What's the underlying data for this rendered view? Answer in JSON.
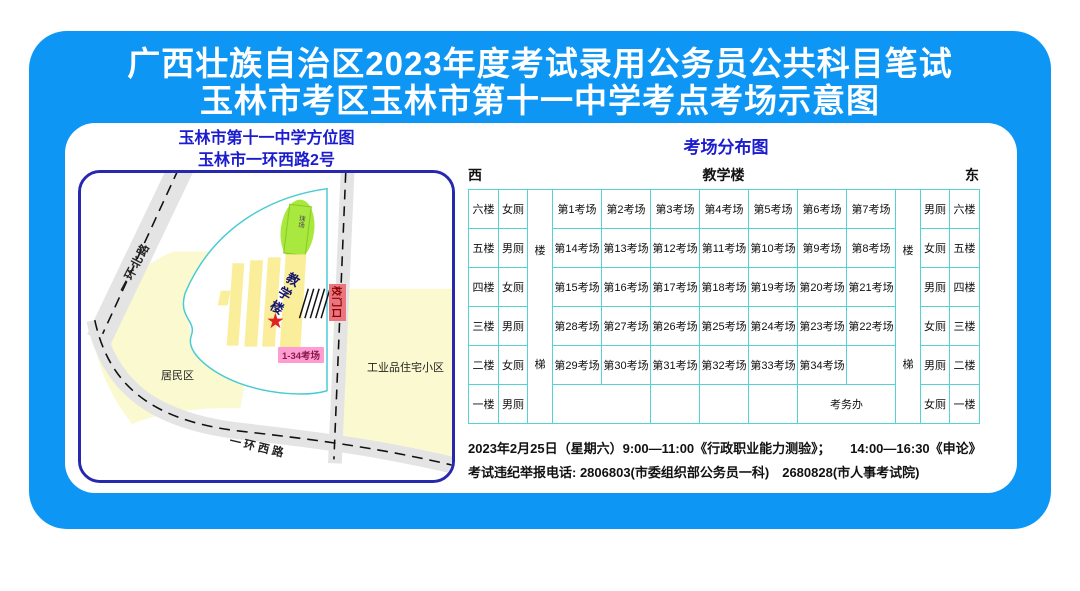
{
  "title": {
    "line1": "广西壮族自治区2023年度考试录用公务员公共科目笔试",
    "line2": "玉林市考区玉林市第十一中学考点考场示意图"
  },
  "map": {
    "title_line1": "玉林市第十一中学方位图",
    "title_line2": "玉林市一环西路2号",
    "road_north_label": "一环北路",
    "road_west_label": "一环西路",
    "field_label": "球场",
    "building_label": "教学楼",
    "star_icon": "★",
    "exam_rooms_label": "1-34考场",
    "gate_label": "校门口",
    "residential_label": "居民区",
    "industrial_label": "工业品住宅小区"
  },
  "distribution": {
    "title": "考场分布图",
    "west_label": "西",
    "east_label": "东",
    "building_header": "教学楼",
    "stairs_chars": [
      "楼",
      "梯"
    ],
    "rows": [
      {
        "floor_west": "六楼",
        "toilet_west": "女厕",
        "rooms": [
          "第1考场",
          "第2考场",
          "第3考场",
          "第4考场",
          "第5考场",
          "第6考场",
          "第7考场"
        ],
        "toilet_east": "男厕",
        "floor_east": "六楼"
      },
      {
        "floor_west": "五楼",
        "toilet_west": "男厕",
        "rooms": [
          "第14考场",
          "第13考场",
          "第12考场",
          "第11考场",
          "第10考场",
          "第9考场",
          "第8考场"
        ],
        "toilet_east": "女厕",
        "floor_east": "五楼"
      },
      {
        "floor_west": "四楼",
        "toilet_west": "女厕",
        "rooms": [
          "第15考场",
          "第16考场",
          "第17考场",
          "第18考场",
          "第19考场",
          "第20考场",
          "第21考场"
        ],
        "toilet_east": "男厕",
        "floor_east": "四楼"
      },
      {
        "floor_west": "三楼",
        "toilet_west": "男厕",
        "rooms": [
          "第28考场",
          "第27考场",
          "第26考场",
          "第25考场",
          "第24考场",
          "第23考场",
          "第22考场"
        ],
        "toilet_east": "女厕",
        "floor_east": "三楼"
      },
      {
        "floor_west": "二楼",
        "toilet_west": "女厕",
        "rooms": [
          "第29考场",
          "第30考场",
          "第31考场",
          "第32考场",
          "第33考场",
          "第34考场",
          ""
        ],
        "toilet_east": "男厕",
        "floor_east": "二楼"
      },
      {
        "floor_west": "一楼",
        "toilet_west": "男厕",
        "ground_cells": [
          "",
          "",
          "",
          "",
          "考务办"
        ],
        "toilet_east": "女厕",
        "floor_east": "一楼"
      }
    ]
  },
  "footer": {
    "line1": "2023年2月25日（星期六）9:00—11:00《行政职业能力测验》；　　14:00—16:30《申论》",
    "line2": "考试违纪举报电话: 2806803(市委组织部公务员一科)　2680828(市人事考试院)"
  },
  "colors": {
    "poster_blue": "#0E96F5",
    "heading_navy": "#1b1bd0",
    "map_border_navy": "#2828AE",
    "table_border_cyan": "#55D2D6",
    "area_yellow": "#FBF9CF",
    "building_yellow": "#FBEE9A",
    "field_green": "#A9E83E",
    "star_red": "#E02222",
    "gate_red": "#E9767E",
    "rooms_pink": "#FF9CD2"
  }
}
